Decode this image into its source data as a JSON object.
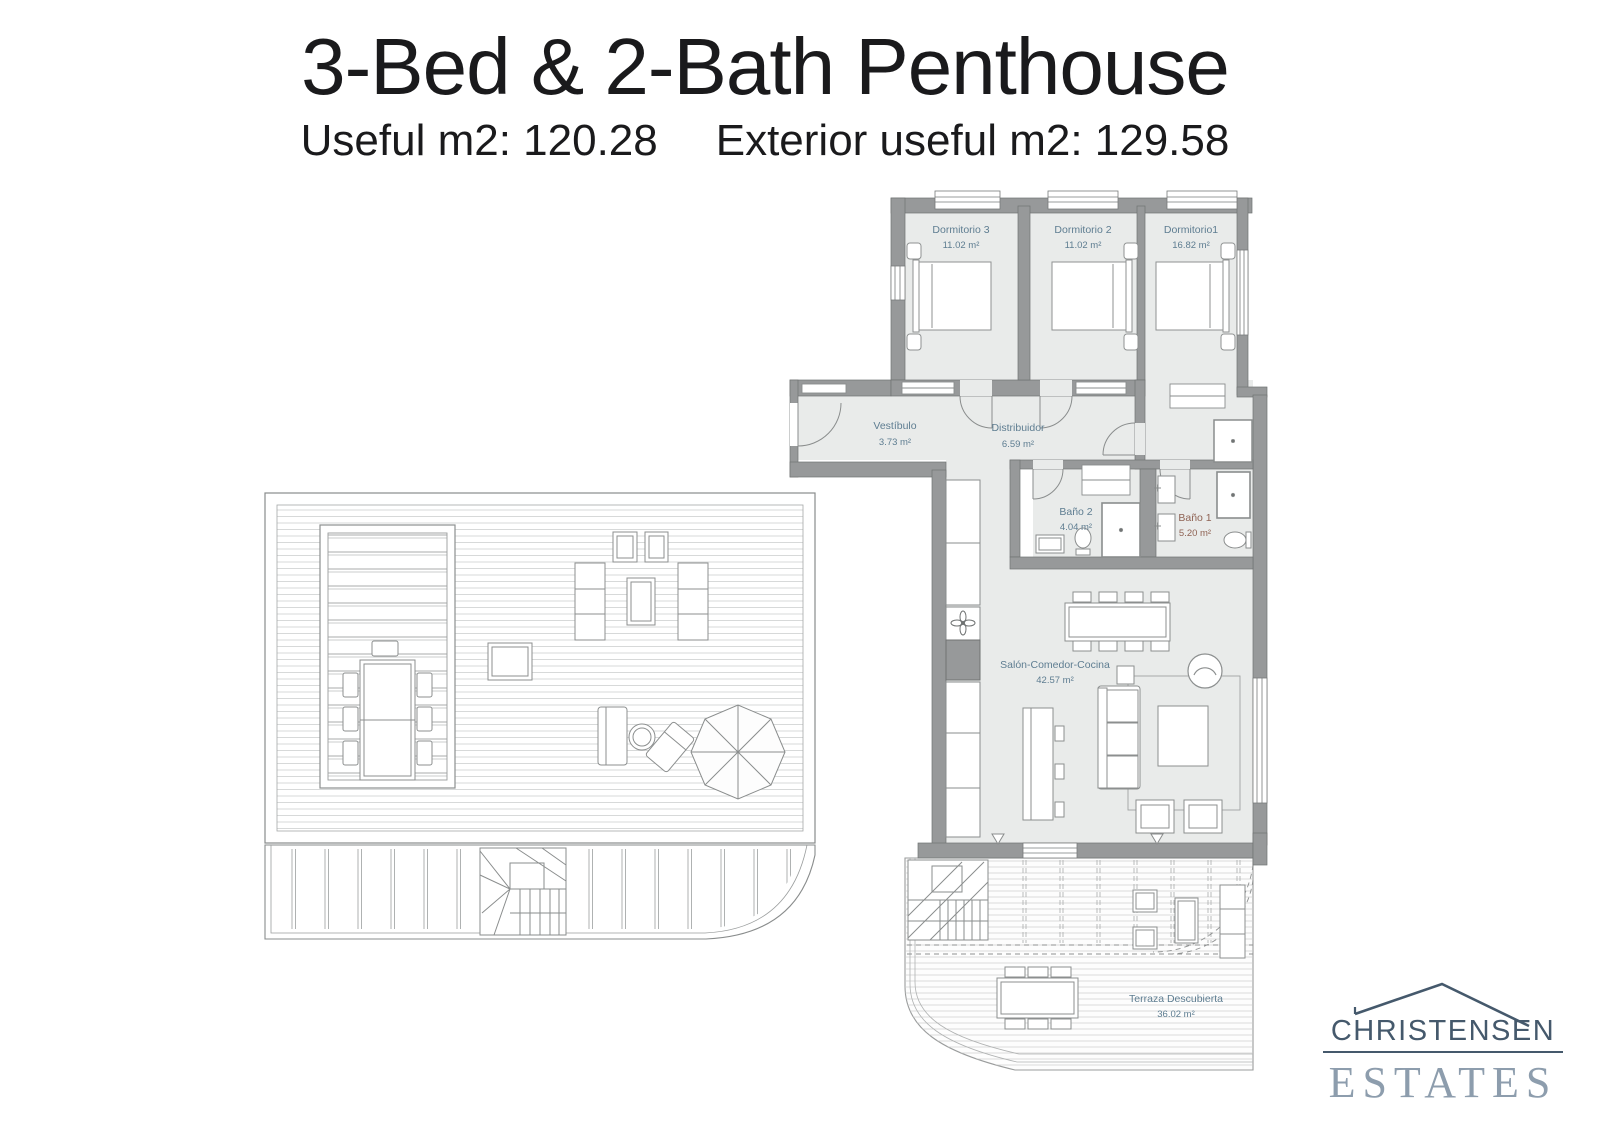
{
  "header": {
    "title": "3-Bed & 2-Bath Penthouse",
    "subtitle": {
      "useful": "Useful m2: 120.28",
      "exterior": "Exterior useful m2: 129.58"
    }
  },
  "floorplan": {
    "rooms": {
      "dormitorio3": {
        "name": "Dormitorio 3",
        "area": "11.02 m²"
      },
      "dormitorio2": {
        "name": "Dormitorio 2",
        "area": "11.02 m²"
      },
      "dormitorio1": {
        "name": "Dormitorio1",
        "area": "16.82 m²"
      },
      "vestibulo": {
        "name": "Vestíbulo",
        "area": "3.73 m²"
      },
      "distribuidor": {
        "name": "Distribuidor",
        "area": "6.59 m²"
      },
      "bano2": {
        "name": "Baño 2",
        "area": "4.04 m²"
      },
      "bano1": {
        "name": "Baño 1",
        "area": "5.20 m²"
      },
      "salon": {
        "name": "Salón-Comedor-Cocina",
        "area": "42.57 m²"
      },
      "terraza": {
        "name": "Terraza Descubierta",
        "area": "36.02 m²"
      }
    }
  },
  "logo": {
    "brand": "CHRISTENSEN",
    "suffix": "ESTATES"
  },
  "colors": {
    "wall": "#97999a",
    "floor": "#e9ebea",
    "room_label": "#5e7d91",
    "bath1_label": "#8f6354",
    "title_text": "#1a1a1c",
    "logo_dark": "#45596c",
    "logo_light": "#8d9dad"
  }
}
